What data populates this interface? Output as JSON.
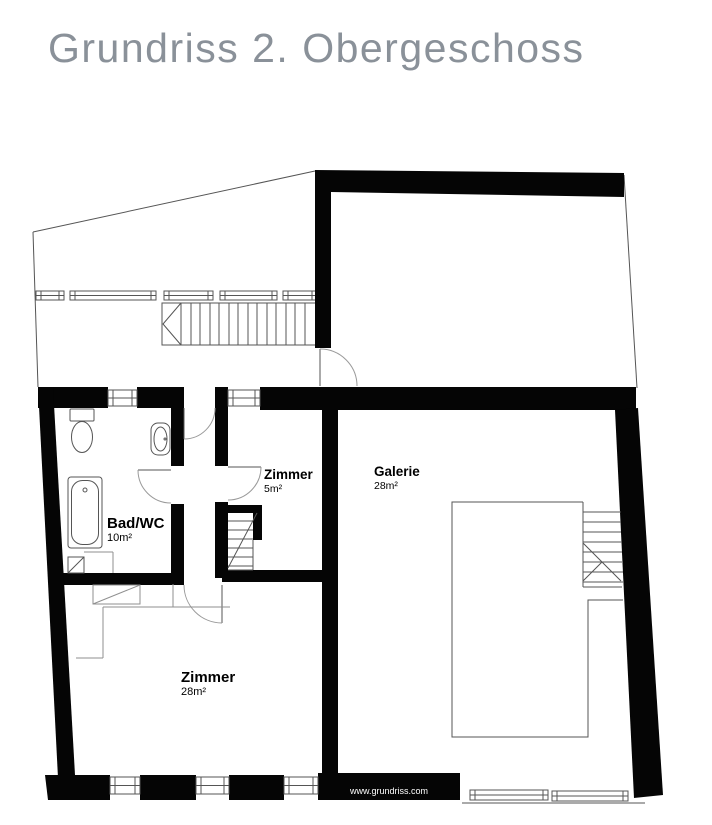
{
  "title": "Grundriss 2. Obergeschoss",
  "watermark": "www.grundriss.com",
  "rooms": {
    "zimmer_small": {
      "name": "Zimmer",
      "area": "5m²"
    },
    "galerie": {
      "name": "Galerie",
      "area": "28m²"
    },
    "bad_wc": {
      "name": "Bad/WC",
      "area": "10m²"
    },
    "zimmer_large": {
      "name": "Zimmer",
      "area": "28m²"
    }
  },
  "colors": {
    "wall": "#050505",
    "thin_line": "#555555",
    "door_arc": "#9a9a9a",
    "title_text": "#8a9199",
    "label_text": "#000000",
    "watermark_text": "#ffffff",
    "background": "#ffffff"
  }
}
